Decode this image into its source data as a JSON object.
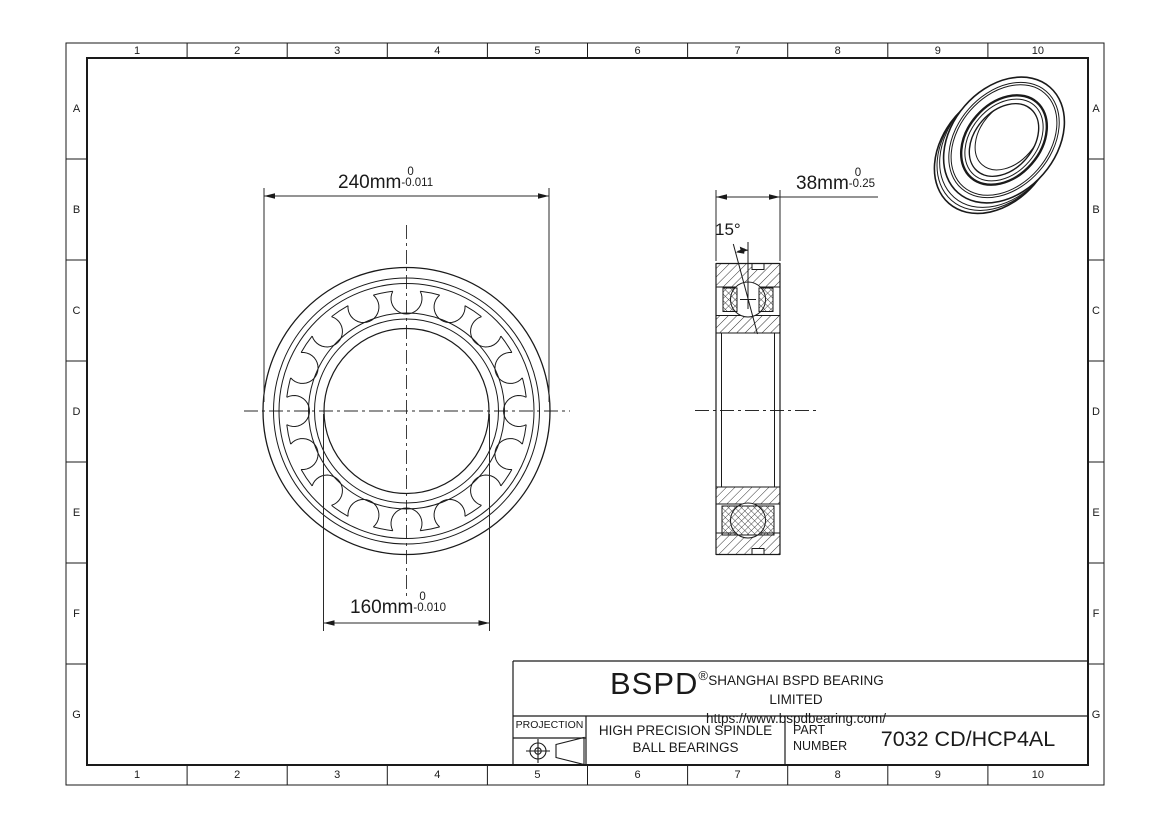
{
  "page": {
    "background": "#ffffff",
    "ink": "#1a1a1a"
  },
  "grid": {
    "columns": [
      "1",
      "2",
      "3",
      "4",
      "5",
      "6",
      "7",
      "8",
      "9",
      "10"
    ],
    "rows": [
      "A",
      "B",
      "C",
      "D",
      "E",
      "F",
      "G"
    ]
  },
  "dimensions": {
    "outer_diameter": {
      "value": "240mm",
      "tol_upper": "0",
      "tol_lower": "-0.011"
    },
    "bore_diameter": {
      "value": "160mm",
      "tol_upper": "0",
      "tol_lower": "-0.010"
    },
    "width": {
      "value": "38mm",
      "tol_upper": "0",
      "tol_lower": "-0.25"
    },
    "contact_angle": "15°"
  },
  "title_block": {
    "logo": "BSPD",
    "registered": "®",
    "company": "SHANGHAI BSPD BEARING LIMITED",
    "website": "https://www.bspdbearing.com/",
    "projection_label": "PROJECTION",
    "product_line1": "HIGH  PRECISION SPINDLE",
    "product_line2": "BALL BEARINGS",
    "part_label_line1": "PART",
    "part_label_line2": "NUMBER",
    "part_number": "7032 CD/HCP4AL"
  },
  "cage": {
    "center_x": 406.5,
    "center_y": 411,
    "ball_count": 16,
    "pitch_radius": 112.5,
    "ball_radius": 15.5,
    "cage_radius": 120.5
  }
}
